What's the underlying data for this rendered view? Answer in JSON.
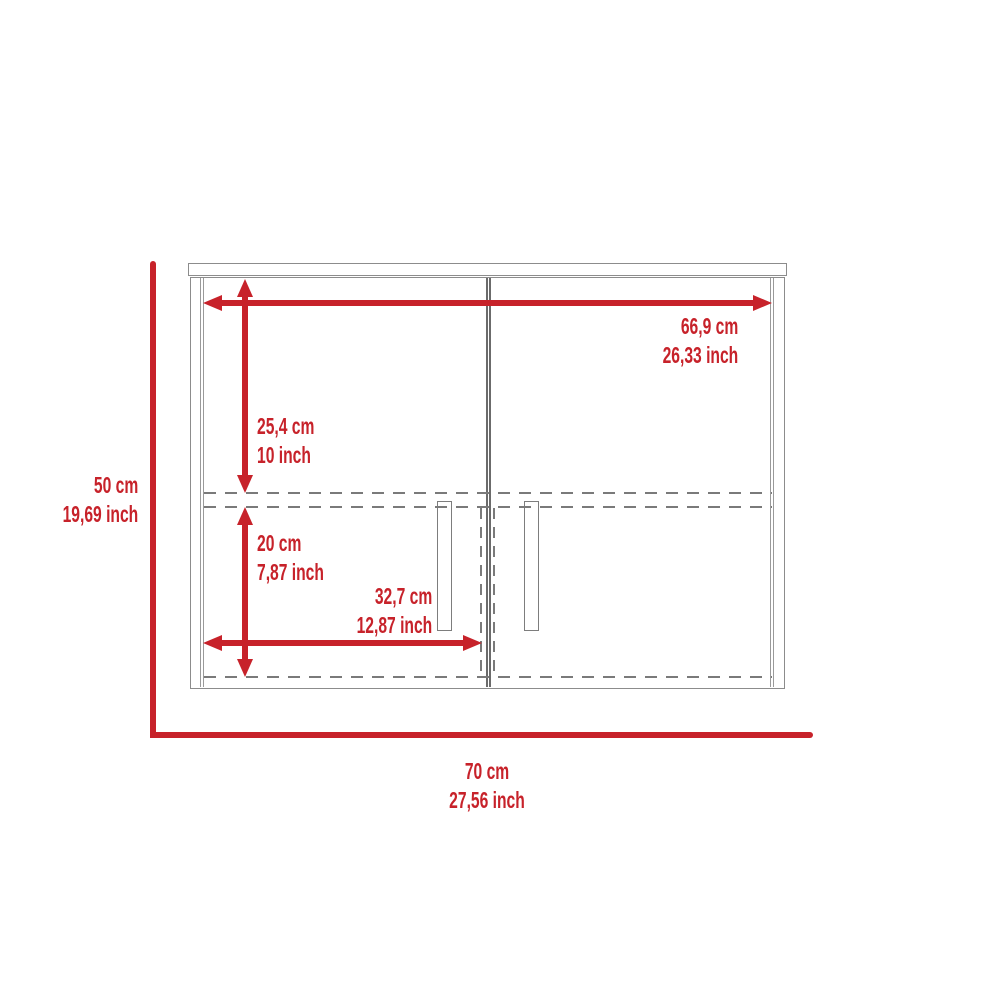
{
  "diagram": {
    "colors": {
      "dimension_red": "#c7222a",
      "outline_gray": "#8c8c8c",
      "dash_gray": "#7a7a7a"
    },
    "dimensions": {
      "inner_width": {
        "cm": "66,9 cm",
        "inch": "26,33 inch"
      },
      "upper_section_height": {
        "cm": "25,4 cm",
        "inch": "10 inch"
      },
      "lower_section_height": {
        "cm": "20 cm",
        "inch": "7,87 inch"
      },
      "door_width": {
        "cm": "32,7 cm",
        "inch": "12,87 inch"
      },
      "overall_height": {
        "cm": "50 cm",
        "inch": "19,69 inch"
      },
      "overall_width": {
        "cm": "70 cm",
        "inch": "27,56 inch"
      }
    }
  }
}
